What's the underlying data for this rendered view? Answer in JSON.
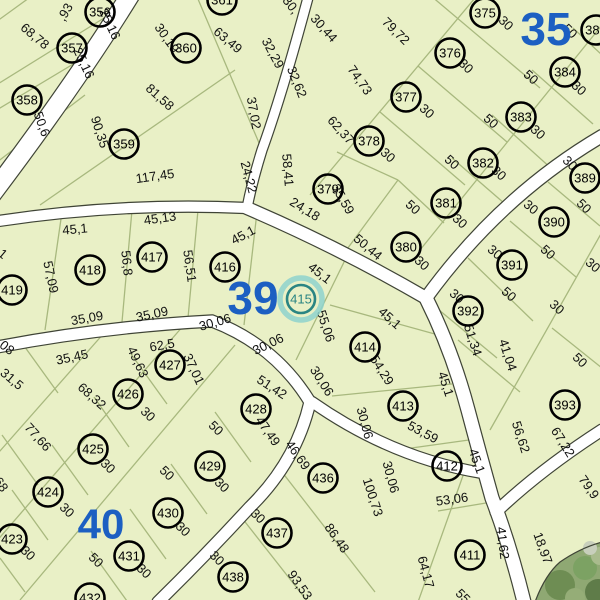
{
  "map": {
    "selected_parcel": "415",
    "colors": {
      "parcel_fill": "#e9f0c6",
      "road_fill": "#ffffff",
      "road_edge": "#3f4436",
      "boundary_line": "#a8b87e",
      "circle_stroke": "#000000",
      "district_blue": "#1c5fc2",
      "selected_teal": "#2a8583",
      "selected_halo": "#8ed2cd",
      "tree_base": "#8fa873",
      "tree_dark": "#6c8a52",
      "tree_light": "#a3b88a",
      "tree_gray": "#c8cfbc"
    },
    "districts": [
      {
        "label": "35",
        "x": 546,
        "y": 29,
        "size": 46
      },
      {
        "label": "39",
        "x": 253,
        "y": 298,
        "size": 46
      },
      {
        "label": "40",
        "x": 101,
        "y": 524,
        "size": 42
      }
    ],
    "parcels": [
      {
        "id": "356",
        "x": 100,
        "y": 12
      },
      {
        "id": "357",
        "x": 72,
        "y": 48
      },
      {
        "id": "358",
        "x": 27,
        "y": 100
      },
      {
        "id": "359",
        "x": 124,
        "y": 144
      },
      {
        "id": "360",
        "x": 186,
        "y": 48
      },
      {
        "id": "361",
        "x": 222,
        "y": 0
      },
      {
        "id": "375",
        "x": 485,
        "y": 13
      },
      {
        "id": "376",
        "x": 450,
        "y": 53
      },
      {
        "id": "377",
        "x": 406,
        "y": 97
      },
      {
        "id": "378",
        "x": 369,
        "y": 141
      },
      {
        "id": "379",
        "x": 328,
        "y": 189
      },
      {
        "id": "380",
        "x": 406,
        "y": 247
      },
      {
        "id": "381",
        "x": 446,
        "y": 203
      },
      {
        "id": "382",
        "x": 483,
        "y": 163
      },
      {
        "id": "383",
        "x": 521,
        "y": 117
      },
      {
        "id": "384",
        "x": 565,
        "y": 72
      },
      {
        "id": "385",
        "x": 596,
        "y": 30
      },
      {
        "id": "389",
        "x": 585,
        "y": 178
      },
      {
        "id": "390",
        "x": 554,
        "y": 222
      },
      {
        "id": "391",
        "x": 512,
        "y": 265
      },
      {
        "id": "392",
        "x": 468,
        "y": 311
      },
      {
        "id": "393",
        "x": 565,
        "y": 405
      },
      {
        "id": "411",
        "x": 470,
        "y": 555
      },
      {
        "id": "412",
        "x": 447,
        "y": 466
      },
      {
        "id": "413",
        "x": 403,
        "y": 406
      },
      {
        "id": "414",
        "x": 365,
        "y": 347
      },
      {
        "id": "415",
        "x": 301,
        "y": 299,
        "selected": true
      },
      {
        "id": "416",
        "x": 225,
        "y": 267
      },
      {
        "id": "417",
        "x": 152,
        "y": 257
      },
      {
        "id": "418",
        "x": 90,
        "y": 270
      },
      {
        "id": "419",
        "x": 12,
        "y": 290
      },
      {
        "id": "423",
        "x": 12,
        "y": 539
      },
      {
        "id": "424",
        "x": 48,
        "y": 492
      },
      {
        "id": "425",
        "x": 93,
        "y": 449
      },
      {
        "id": "426",
        "x": 128,
        "y": 394
      },
      {
        "id": "427",
        "x": 170,
        "y": 365
      },
      {
        "id": "428",
        "x": 256,
        "y": 409
      },
      {
        "id": "429",
        "x": 210,
        "y": 466
      },
      {
        "id": "430",
        "x": 168,
        "y": 513
      },
      {
        "id": "431",
        "x": 129,
        "y": 556
      },
      {
        "id": "432",
        "x": 90,
        "y": 598
      },
      {
        "id": "436",
        "x": 323,
        "y": 478
      },
      {
        "id": "437",
        "x": 277,
        "y": 533
      },
      {
        "id": "438",
        "x": 233,
        "y": 577
      }
    ],
    "dimensions": [
      {
        "t": ",93",
        "x": 65,
        "y": 12,
        "r": -60
      },
      {
        "t": "68,78",
        "x": 35,
        "y": 36,
        "r": 40
      },
      {
        "t": "25,16",
        "x": 110,
        "y": 24,
        "r": 65
      },
      {
        "t": "25,16",
        "x": 84,
        "y": 63,
        "r": 65
      },
      {
        "t": "30,19",
        "x": 167,
        "y": 38,
        "r": 55
      },
      {
        "t": "63,49",
        "x": 228,
        "y": 40,
        "r": 40
      },
      {
        "t": "32,29",
        "x": 273,
        "y": 53,
        "r": 62
      },
      {
        "t": "30,",
        "x": 291,
        "y": 5,
        "r": 52
      },
      {
        "t": "30,44",
        "x": 324,
        "y": 28,
        "r": 48
      },
      {
        "t": "79,72",
        "x": 396,
        "y": 31,
        "r": 45
      },
      {
        "t": "74,73",
        "x": 360,
        "y": 80,
        "r": 55
      },
      {
        "t": "81,58",
        "x": 160,
        "y": 97,
        "r": 42
      },
      {
        "t": "50,6",
        "x": 42,
        "y": 124,
        "r": 70
      },
      {
        "t": "90,35",
        "x": 100,
        "y": 132,
        "r": 72
      },
      {
        "t": "32,62",
        "x": 297,
        "y": 82,
        "r": 68
      },
      {
        "t": "37,02",
        "x": 254,
        "y": 113,
        "r": 80
      },
      {
        "t": "62,37",
        "x": 341,
        "y": 130,
        "r": 48
      },
      {
        "t": "117,45",
        "x": 155,
        "y": 176,
        "r": -8
      },
      {
        "t": "58,41",
        "x": 288,
        "y": 170,
        "r": 85
      },
      {
        "t": "24,22",
        "x": 249,
        "y": 177,
        "r": 75
      },
      {
        "t": "24,18",
        "x": 305,
        "y": 209,
        "r": 32
      },
      {
        "t": "35,59",
        "x": 343,
        "y": 199,
        "r": 60
      },
      {
        "t": "50,44",
        "x": 368,
        "y": 247,
        "r": 40
      },
      {
        "t": "30",
        "x": 506,
        "y": 23,
        "r": 45
      },
      {
        "t": "50",
        "x": 570,
        "y": 31,
        "r": 45
      },
      {
        "t": "30",
        "x": 466,
        "y": 66,
        "r": 45
      },
      {
        "t": "50",
        "x": 531,
        "y": 77,
        "r": 42
      },
      {
        "t": "30",
        "x": 579,
        "y": 88,
        "r": 42
      },
      {
        "t": "30",
        "x": 427,
        "y": 111,
        "r": 42
      },
      {
        "t": "50",
        "x": 491,
        "y": 121,
        "r": 42
      },
      {
        "t": "30",
        "x": 538,
        "y": 132,
        "r": 42
      },
      {
        "t": "30",
        "x": 388,
        "y": 155,
        "r": 42
      },
      {
        "t": "50",
        "x": 452,
        "y": 162,
        "r": 42
      },
      {
        "t": "30",
        "x": 499,
        "y": 173,
        "r": 42
      },
      {
        "t": "30",
        "x": 570,
        "y": 163,
        "r": 45
      },
      {
        "t": "50",
        "x": 413,
        "y": 207,
        "r": 42
      },
      {
        "t": "30",
        "x": 460,
        "y": 221,
        "r": 42
      },
      {
        "t": "30",
        "x": 422,
        "y": 263,
        "r": 42
      },
      {
        "t": "30",
        "x": 531,
        "y": 207,
        "r": 40
      },
      {
        "t": "50",
        "x": 584,
        "y": 206,
        "r": 45
      },
      {
        "t": "50",
        "x": 548,
        "y": 252,
        "r": 42
      },
      {
        "t": "30",
        "x": 495,
        "y": 252,
        "r": 40
      },
      {
        "t": "30",
        "x": 593,
        "y": 265,
        "r": 40
      },
      {
        "t": "50",
        "x": 509,
        "y": 294,
        "r": 42
      },
      {
        "t": "30",
        "x": 557,
        "y": 307,
        "r": 42
      },
      {
        "t": "30",
        "x": 457,
        "y": 296,
        "r": 40
      },
      {
        "t": "50",
        "x": 580,
        "y": 360,
        "r": 45
      },
      {
        "t": "51,34",
        "x": 473,
        "y": 340,
        "r": 72
      },
      {
        "t": "41,04",
        "x": 508,
        "y": 355,
        "r": 72
      },
      {
        "t": "45,1",
        "x": -4,
        "y": 248,
        "r": 40
      },
      {
        "t": "45,1",
        "x": 75,
        "y": 229,
        "r": -5
      },
      {
        "t": "45,13",
        "x": 160,
        "y": 218,
        "r": -8
      },
      {
        "t": "45,1",
        "x": 243,
        "y": 235,
        "r": -28
      },
      {
        "t": "45,1",
        "x": 320,
        "y": 273,
        "r": 38
      },
      {
        "t": "45,1",
        "x": 390,
        "y": 318,
        "r": 42
      },
      {
        "t": "45,1",
        "x": 446,
        "y": 384,
        "r": 72
      },
      {
        "t": "45,1",
        "x": 477,
        "y": 461,
        "r": 70
      },
      {
        "t": "57,09",
        "x": 51,
        "y": 277,
        "r": 78
      },
      {
        "t": "56,8",
        "x": 127,
        "y": 263,
        "r": 84
      },
      {
        "t": "56,51",
        "x": 190,
        "y": 266,
        "r": 82
      },
      {
        "t": "35,09",
        "x": 87,
        "y": 318,
        "r": -10
      },
      {
        "t": "35,09",
        "x": 152,
        "y": 314,
        "r": -12
      },
      {
        "t": "30,06",
        "x": 215,
        "y": 322,
        "r": -16
      },
      {
        "t": "30,06",
        "x": 268,
        "y": 344,
        "r": -26
      },
      {
        "t": "30,06",
        "x": 322,
        "y": 381,
        "r": 58
      },
      {
        "t": "55,06",
        "x": 326,
        "y": 326,
        "r": 72
      },
      {
        "t": "54,29",
        "x": 382,
        "y": 370,
        "r": 58
      },
      {
        "t": "30,06",
        "x": 365,
        "y": 423,
        "r": 75
      },
      {
        "t": "53,59",
        "x": 423,
        "y": 432,
        "r": 28
      },
      {
        "t": "30,06",
        "x": 391,
        "y": 477,
        "r": 75
      },
      {
        "t": "100,73",
        "x": 373,
        "y": 497,
        "r": 72
      },
      {
        "t": "62,5",
        "x": 162,
        "y": 345,
        "r": -10
      },
      {
        "t": "49,63",
        "x": 138,
        "y": 362,
        "r": 65
      },
      {
        "t": "37,01",
        "x": 194,
        "y": 369,
        "r": 65
      },
      {
        "t": "35,45",
        "x": 72,
        "y": 357,
        "r": -12
      },
      {
        "t": "68,32",
        "x": 92,
        "y": 396,
        "r": 42
      },
      {
        "t": "31,5",
        "x": 12,
        "y": 379,
        "r": 40
      },
      {
        "t": "63,08",
        "x": 0,
        "y": 342,
        "r": 38
      },
      {
        "t": "30",
        "x": 148,
        "y": 414,
        "r": 45
      },
      {
        "t": "50",
        "x": 216,
        "y": 428,
        "r": 45
      },
      {
        "t": "51,42",
        "x": 272,
        "y": 387,
        "r": 33
      },
      {
        "t": "47,49",
        "x": 268,
        "y": 431,
        "r": 55
      },
      {
        "t": "77,66",
        "x": 38,
        "y": 437,
        "r": 48
      },
      {
        "t": "49,68",
        "x": -4,
        "y": 477,
        "r": 55
      },
      {
        "t": "30",
        "x": 108,
        "y": 466,
        "r": 45
      },
      {
        "t": "30",
        "x": 67,
        "y": 510,
        "r": 45
      },
      {
        "t": "30",
        "x": 28,
        "y": 553,
        "r": 45
      },
      {
        "t": "50",
        "x": 167,
        "y": 473,
        "r": 45
      },
      {
        "t": "30",
        "x": 183,
        "y": 529,
        "r": 45
      },
      {
        "t": "50",
        "x": 96,
        "y": 560,
        "r": 45
      },
      {
        "t": "30",
        "x": 144,
        "y": 571,
        "r": 45
      },
      {
        "t": "30",
        "x": 222,
        "y": 485,
        "r": 45
      },
      {
        "t": "30",
        "x": 258,
        "y": 516,
        "r": 45
      },
      {
        "t": "46,69",
        "x": 298,
        "y": 455,
        "r": 55
      },
      {
        "t": "30",
        "x": 217,
        "y": 558,
        "r": 45
      },
      {
        "t": "86,48",
        "x": 337,
        "y": 538,
        "r": 55
      },
      {
        "t": "93,53",
        "x": 300,
        "y": 585,
        "r": 55
      },
      {
        "t": "53,06",
        "x": 452,
        "y": 499,
        "r": -8
      },
      {
        "t": "56,62",
        "x": 521,
        "y": 437,
        "r": 72
      },
      {
        "t": "67,22",
        "x": 563,
        "y": 442,
        "r": 58
      },
      {
        "t": "41,62",
        "x": 503,
        "y": 543,
        "r": 83
      },
      {
        "t": "64,17",
        "x": 426,
        "y": 572,
        "r": 75
      },
      {
        "t": "18,97",
        "x": 543,
        "y": 548,
        "r": 70
      },
      {
        "t": "79,9",
        "x": 589,
        "y": 487,
        "r": 55
      },
      {
        "t": "55",
        "x": 463,
        "y": 596,
        "r": 45
      }
    ],
    "roads": [
      {
        "d": "M132,-8 Q78,80 -8,194",
        "w": 18
      },
      {
        "d": "M309,-6 Q282,95 262,150 Q252,182 247,208",
        "w": 9
      },
      {
        "d": "M-8,222 Q120,202 247,208",
        "w": 10
      },
      {
        "d": "M247,208 Q340,248 426,298",
        "w": 12
      },
      {
        "d": "M602,136 Q500,196 426,298",
        "w": 12
      },
      {
        "d": "M426,298 Q452,350 468,410 Q480,455 492,498 Q510,545 524,602",
        "w": 13
      },
      {
        "d": "M496,512 Q540,470 602,430",
        "w": 11
      },
      {
        "d": "M-8,348 Q100,327 212,321 Q275,345 310,402 Q296,462 250,507 Q204,557 158,602",
        "w": 11
      },
      {
        "d": "M312,402 Q392,458 482,473",
        "w": 10
      }
    ],
    "boundaries": [
      [
        40,
        -10,
        -40,
        48
      ],
      [
        125,
        5,
        -20,
        95
      ],
      [
        105,
        45,
        -20,
        120
      ],
      [
        85,
        95,
        -20,
        175
      ],
      [
        235,
        70,
        40,
        205
      ],
      [
        195,
        -8,
        262,
        150
      ],
      [
        310,
        195,
        480,
        -8
      ],
      [
        602,
        25,
        420,
        250
      ],
      [
        424,
        -10,
        540,
        88
      ],
      [
        418,
        66,
        507,
        142
      ],
      [
        380,
        112,
        465,
        185
      ],
      [
        337,
        152,
        398,
        180
      ],
      [
        398,
        180,
        444,
        223
      ],
      [
        398,
        180,
        342,
        256
      ],
      [
        452,
        158,
        512,
        210
      ],
      [
        492,
        115,
        553,
        170
      ],
      [
        532,
        70,
        593,
        124
      ],
      [
        573,
        28,
        602,
        55
      ],
      [
        548,
        182,
        600,
        226
      ],
      [
        510,
        221,
        576,
        277
      ],
      [
        468,
        258,
        533,
        321
      ],
      [
        433,
        305,
        497,
        358
      ],
      [
        602,
        232,
        490,
        430
      ],
      [
        458,
        340,
        520,
        392
      ],
      [
        552,
        328,
        602,
        368
      ],
      [
        62,
        212,
        45,
        330
      ],
      [
        132,
        210,
        122,
        322
      ],
      [
        198,
        210,
        188,
        318
      ],
      [
        257,
        212,
        244,
        325
      ],
      [
        348,
        254,
        296,
        360
      ],
      [
        330,
        305,
        442,
        336
      ],
      [
        332,
        396,
        452,
        384
      ],
      [
        390,
        451,
        476,
        439
      ],
      [
        438,
        511,
        492,
        502
      ],
      [
        465,
        470,
        418,
        602
      ],
      [
        282,
        472,
        375,
        592
      ],
      [
        242,
        518,
        330,
        630
      ],
      [
        235,
        345,
        20,
        600
      ],
      [
        190,
        318,
        -5,
        543
      ],
      [
        112,
        324,
        -8,
        460
      ],
      [
        131,
        354,
        167,
        404
      ],
      [
        94,
        397,
        129,
        447
      ],
      [
        52,
        445,
        88,
        495
      ],
      [
        12,
        490,
        48,
        540
      ],
      [
        0,
        558,
        25,
        592
      ],
      [
        215,
        412,
        251,
        462
      ],
      [
        171,
        464,
        207,
        514
      ],
      [
        130,
        509,
        166,
        559
      ],
      [
        91,
        551,
        127,
        601
      ],
      [
        2,
        435,
        38,
        485
      ],
      [
        22,
        343,
        58,
        393
      ]
    ],
    "offmap_area": {
      "outline": "M535,602 Q545,575 560,562 Q580,548 602,542 L602,602 Z",
      "edge": "M535,602 Q545,575 560,562 Q580,548 602,542",
      "blobs": [
        [
          560,
          585,
          15,
          "#6e8d53"
        ],
        [
          585,
          568,
          12,
          "#7ca263"
        ],
        [
          598,
          592,
          13,
          "#5f7c49"
        ],
        [
          575,
          598,
          10,
          "#95ad77"
        ],
        [
          600,
          556,
          9,
          "#a9bb8d"
        ],
        [
          590,
          548,
          7,
          "#c8cfbc"
        ]
      ]
    }
  }
}
